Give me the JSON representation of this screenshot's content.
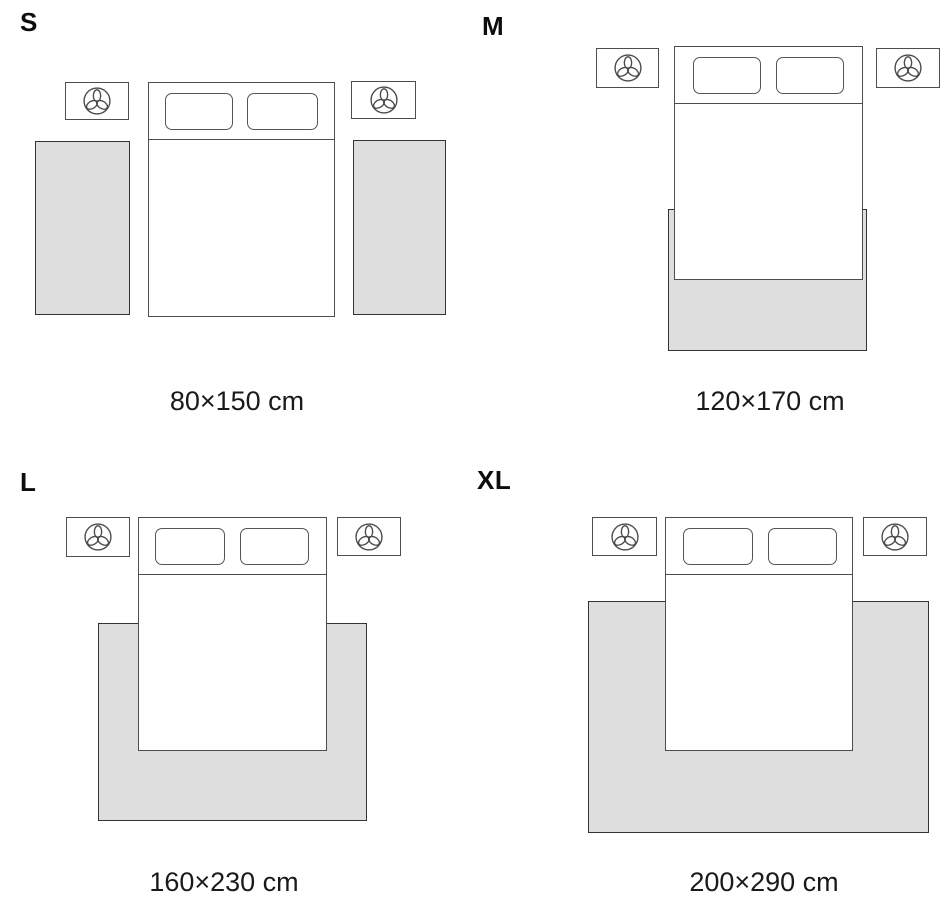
{
  "colors": {
    "background": "#ffffff",
    "rug_fill": "#dedede",
    "outline": "#4d4d4d",
    "rug_outline": "#333333",
    "text": "#111111"
  },
  "icons": {
    "nightstand_decoration": "plant-icon"
  },
  "sizes": [
    {
      "label": "S",
      "dimensions": "80×150 cm"
    },
    {
      "label": "M",
      "dimensions": "120×170 cm"
    },
    {
      "label": "L",
      "dimensions": "160×230 cm"
    },
    {
      "label": "XL",
      "dimensions": "200×290 cm"
    }
  ]
}
